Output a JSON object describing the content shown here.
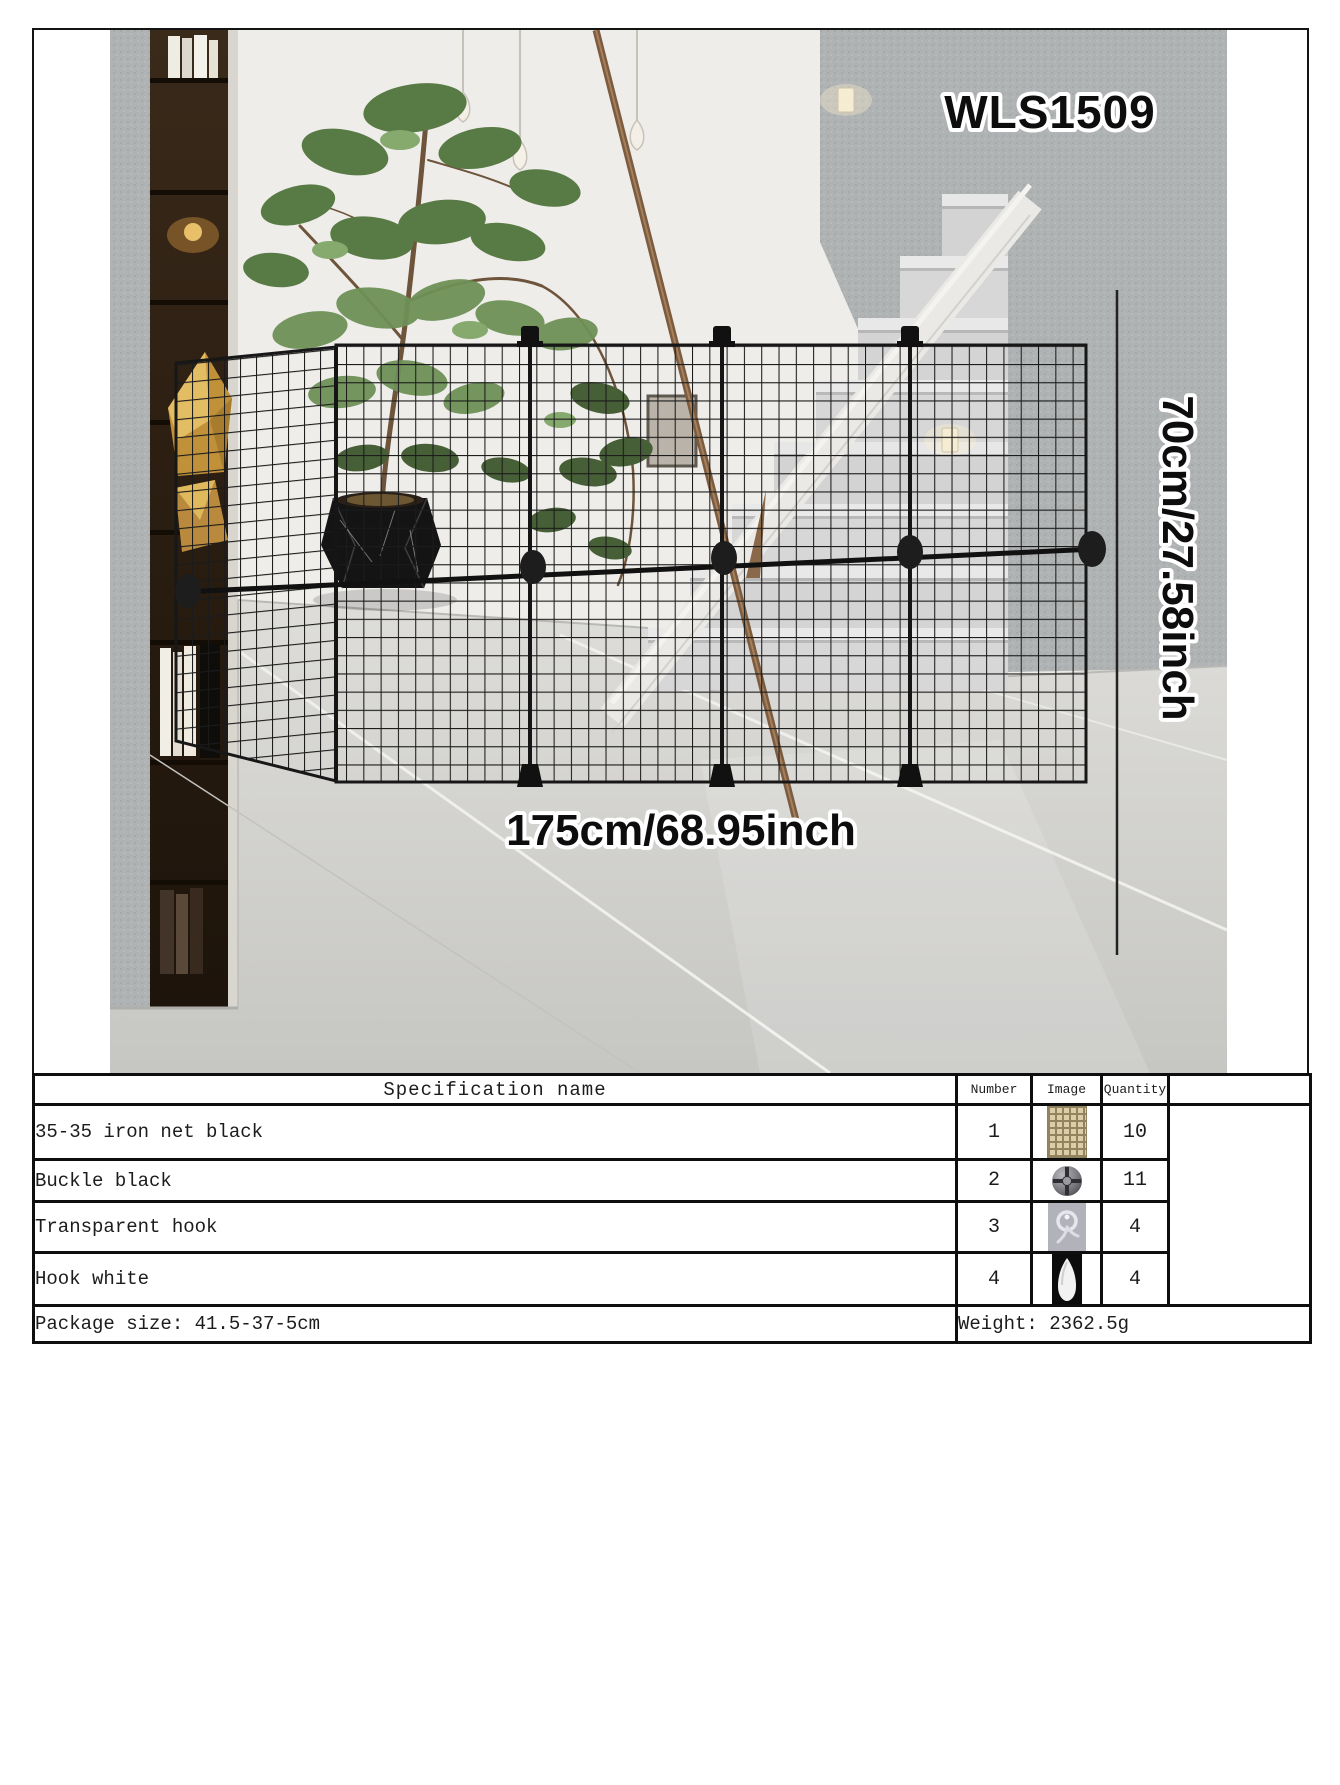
{
  "product": {
    "model": "WLS1509",
    "width_label": "175cm/68.95inch",
    "height_label": "70cm/27.58inch"
  },
  "colors": {
    "accent_black": "#141414",
    "wall_gray": "#b0b3b3",
    "net_thumb_tan": "#dbcda5"
  },
  "table": {
    "headers": {
      "name": "Specification name",
      "number": "Number",
      "image": "Image",
      "quantity": "Quantity"
    },
    "rows": [
      {
        "name": "35-35 iron net black",
        "number": "1",
        "image_icon": "iron-net-swatch",
        "quantity": "10"
      },
      {
        "name": "Buckle black",
        "number": "2",
        "image_icon": "buckle-swatch",
        "quantity": "11"
      },
      {
        "name": "Transparent hook",
        "number": "3",
        "image_icon": "transparent-hook-swatch",
        "quantity": "4"
      },
      {
        "name": "Hook white",
        "number": "4",
        "image_icon": "white-hook-swatch",
        "quantity": "4"
      }
    ],
    "footer": {
      "package": "Package size: 41.5-37-5cm",
      "weight": "Weight: 2362.5g"
    }
  }
}
